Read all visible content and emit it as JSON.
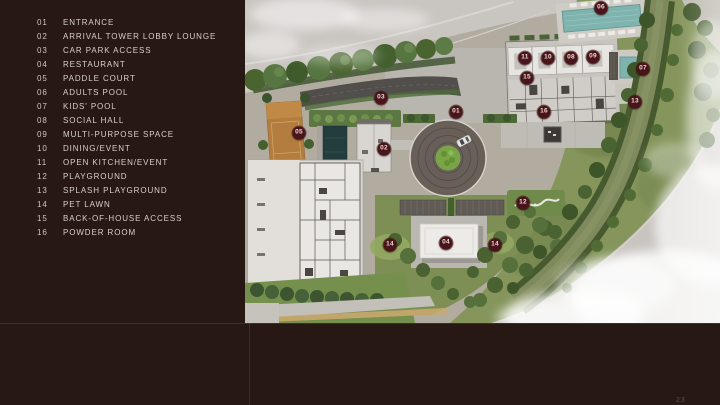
{
  "page": {
    "background_color": "#271813",
    "accent_marker_color": "#49151a",
    "number": "23"
  },
  "legend": {
    "items": [
      {
        "num": "01",
        "label": "ENTRANCE"
      },
      {
        "num": "02",
        "label": "ARRIVAL TOWER LOBBY LOUNGE"
      },
      {
        "num": "03",
        "label": "CAR PARK ACCESS"
      },
      {
        "num": "04",
        "label": "RESTAURANT"
      },
      {
        "num": "05",
        "label": "PADDLE COURT"
      },
      {
        "num": "06",
        "label": "ADULTS POOL"
      },
      {
        "num": "07",
        "label": "KIDS' POOL"
      },
      {
        "num": "08",
        "label": "SOCIAL HALL"
      },
      {
        "num": "09",
        "label": "MULTI-PURPOSE SPACE"
      },
      {
        "num": "10",
        "label": "DINING/EVENT"
      },
      {
        "num": "11",
        "label": "OPEN KITCHEN/EVENT"
      },
      {
        "num": "12",
        "label": "PLAYGROUND"
      },
      {
        "num": "13",
        "label": "SPLASH PLAYGROUND"
      },
      {
        "num": "14",
        "label": "PET LAWN"
      },
      {
        "num": "15",
        "label": "BACK-OF-HOUSE ACCESS"
      },
      {
        "num": "16",
        "label": "POWDER ROOM"
      }
    ]
  },
  "plan": {
    "markers": [
      {
        "num": "01",
        "x": 211,
        "y": 112
      },
      {
        "num": "02",
        "x": 139,
        "y": 149
      },
      {
        "num": "03",
        "x": 136,
        "y": 98
      },
      {
        "num": "04",
        "x": 201,
        "y": 243
      },
      {
        "num": "05",
        "x": 54,
        "y": 133
      },
      {
        "num": "06",
        "x": 356,
        "y": 8
      },
      {
        "num": "07",
        "x": 398,
        "y": 69
      },
      {
        "num": "08",
        "x": 326,
        "y": 58
      },
      {
        "num": "09",
        "x": 348,
        "y": 57
      },
      {
        "num": "10",
        "x": 303,
        "y": 58
      },
      {
        "num": "11",
        "x": 280,
        "y": 58
      },
      {
        "num": "12",
        "x": 278,
        "y": 203
      },
      {
        "num": "13",
        "x": 390,
        "y": 102
      },
      {
        "num": "14",
        "x": 145,
        "y": 245
      },
      {
        "num": "14",
        "x": 250,
        "y": 245
      },
      {
        "num": "15",
        "x": 282,
        "y": 78
      },
      {
        "num": "16",
        "x": 299,
        "y": 112
      }
    ]
  }
}
